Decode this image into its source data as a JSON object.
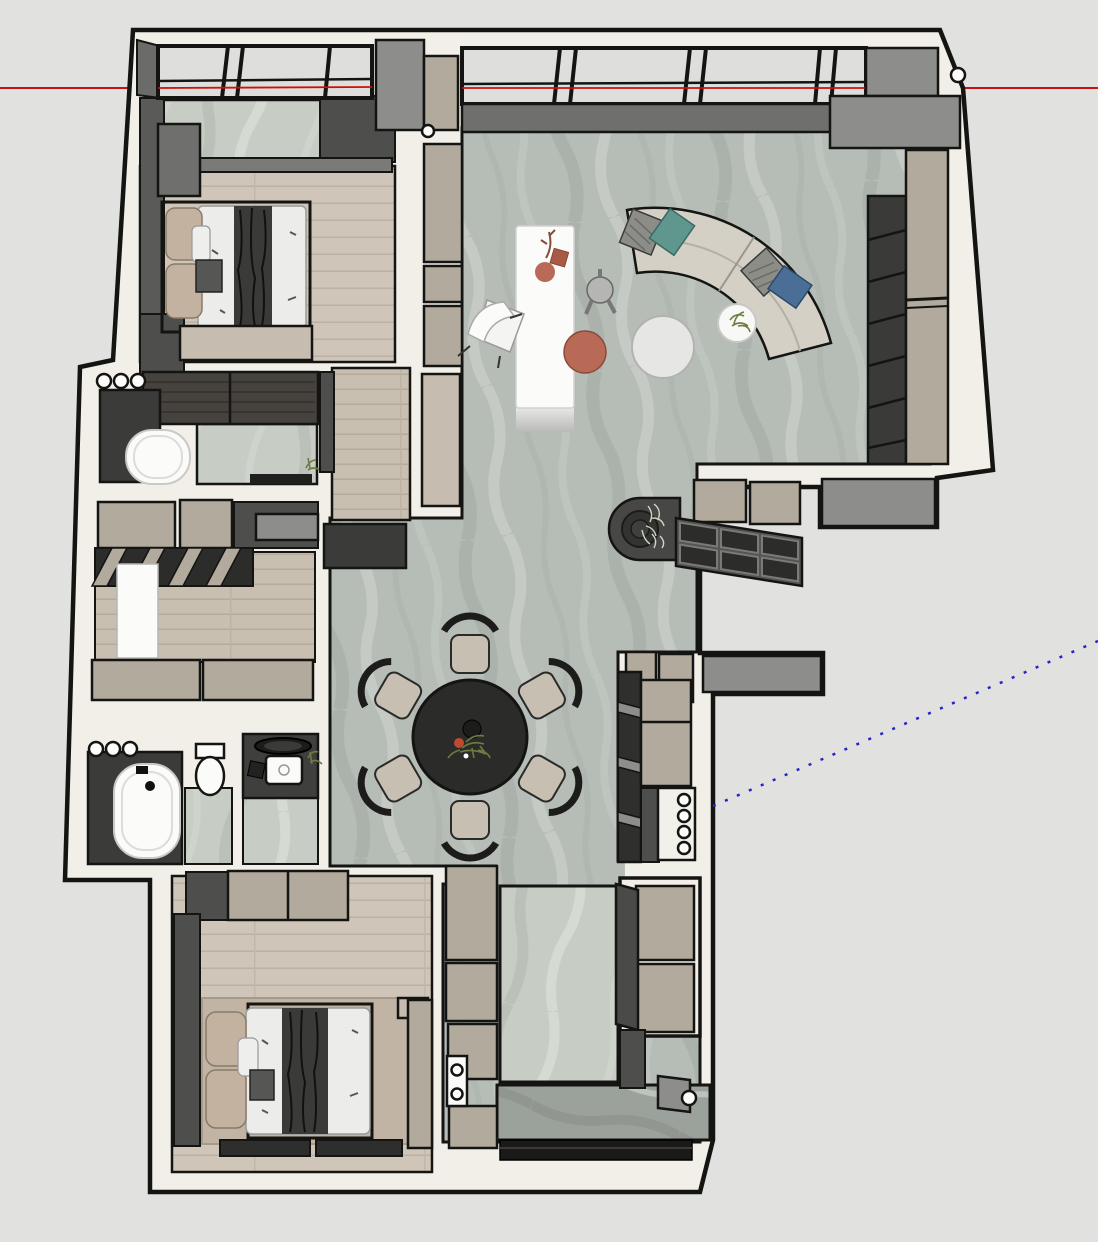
{
  "scene": {
    "app": "3d-model-viewport",
    "description": "Top-down 3D floor plan of an apartment (SketchUp-style viewport), no UI chrome, no text labels",
    "background": "#e1e1df"
  },
  "colors": {
    "background": "#e1e1df",
    "outline": "#141412",
    "wall": "#f1efe8",
    "glass": "#dededc",
    "marble_base": "#b6bcb6",
    "marble_light": "#c7cdc5",
    "marble_dark": "#9ba19b",
    "wood": "#cfc6b9",
    "wood_line": "#bbb2a5",
    "cabinet_beige": "#b2aa9d",
    "cabinet_tan": "#c6bdb0",
    "dark_gray": "#3b3b39",
    "mid_gray": "#4e4e4c",
    "cap_gray": "#8d8d8b",
    "sill_gray": "#6f6f6d",
    "fixture_white": "#fbfbf9",
    "sofa": "#d4d0c6",
    "cushion_teal": "#5f978f",
    "cushion_blue": "#4a6e96",
    "cushion_gray": "#8d8d88",
    "terracotta": "#b96a56",
    "dining_table": "#2b2b29",
    "chair_seat": "#c7bfb2",
    "duvet_white": "#ececea",
    "pillow_tan": "#c3b2a0",
    "rug_tan": "#c2b4a4",
    "axis_red": "#cc1010",
    "axis_blue": "#2424cc",
    "plant_green": "#6d7d3f"
  },
  "axes": {
    "red_axis_y": 88,
    "blue_axis": {
      "x1": 713,
      "y1": 806,
      "x2": 1098,
      "y2": 641
    }
  },
  "rooms": [
    {
      "id": "master-bedroom",
      "floor": "wood"
    },
    {
      "id": "bathroom-top",
      "floor": "marble",
      "fixtures": [
        "round-end-bathtub",
        "vanity-counter"
      ]
    },
    {
      "id": "walk-in-closet",
      "floor": "wood",
      "fixtures": [
        "wardrobes",
        "desk",
        "shelf-band"
      ]
    },
    {
      "id": "bathroom-bottom",
      "floor": "marble",
      "fixtures": [
        "bathtub",
        "toilet",
        "round-basin",
        "square-sink"
      ]
    },
    {
      "id": "second-bedroom",
      "floor": "wood",
      "fixtures": [
        "double-bed",
        "wardrobe",
        "rug",
        "media-band"
      ]
    },
    {
      "id": "living-room",
      "floor": "marble",
      "fixtures": [
        "curved-sofa",
        "coffee-table",
        "side-table",
        "island",
        "tv-slat-wall"
      ]
    },
    {
      "id": "dining-area",
      "floor": "marble",
      "fixtures": [
        "round-table",
        "six-chairs"
      ]
    },
    {
      "id": "kitchen-run",
      "floor": "marble",
      "fixtures": [
        "cabinets",
        "counter-with-knobs"
      ]
    },
    {
      "id": "entry-hall",
      "floor": "marble",
      "fixtures": [
        "cabinets",
        "open-door",
        "entry-landing",
        "threshold"
      ]
    }
  ],
  "counts": {
    "dining_chairs": 6,
    "counter_knobs": 4,
    "wall_dots_bathroom_top": 3,
    "wall_dots_bathroom_bottom": 3,
    "windows_top": 2
  }
}
